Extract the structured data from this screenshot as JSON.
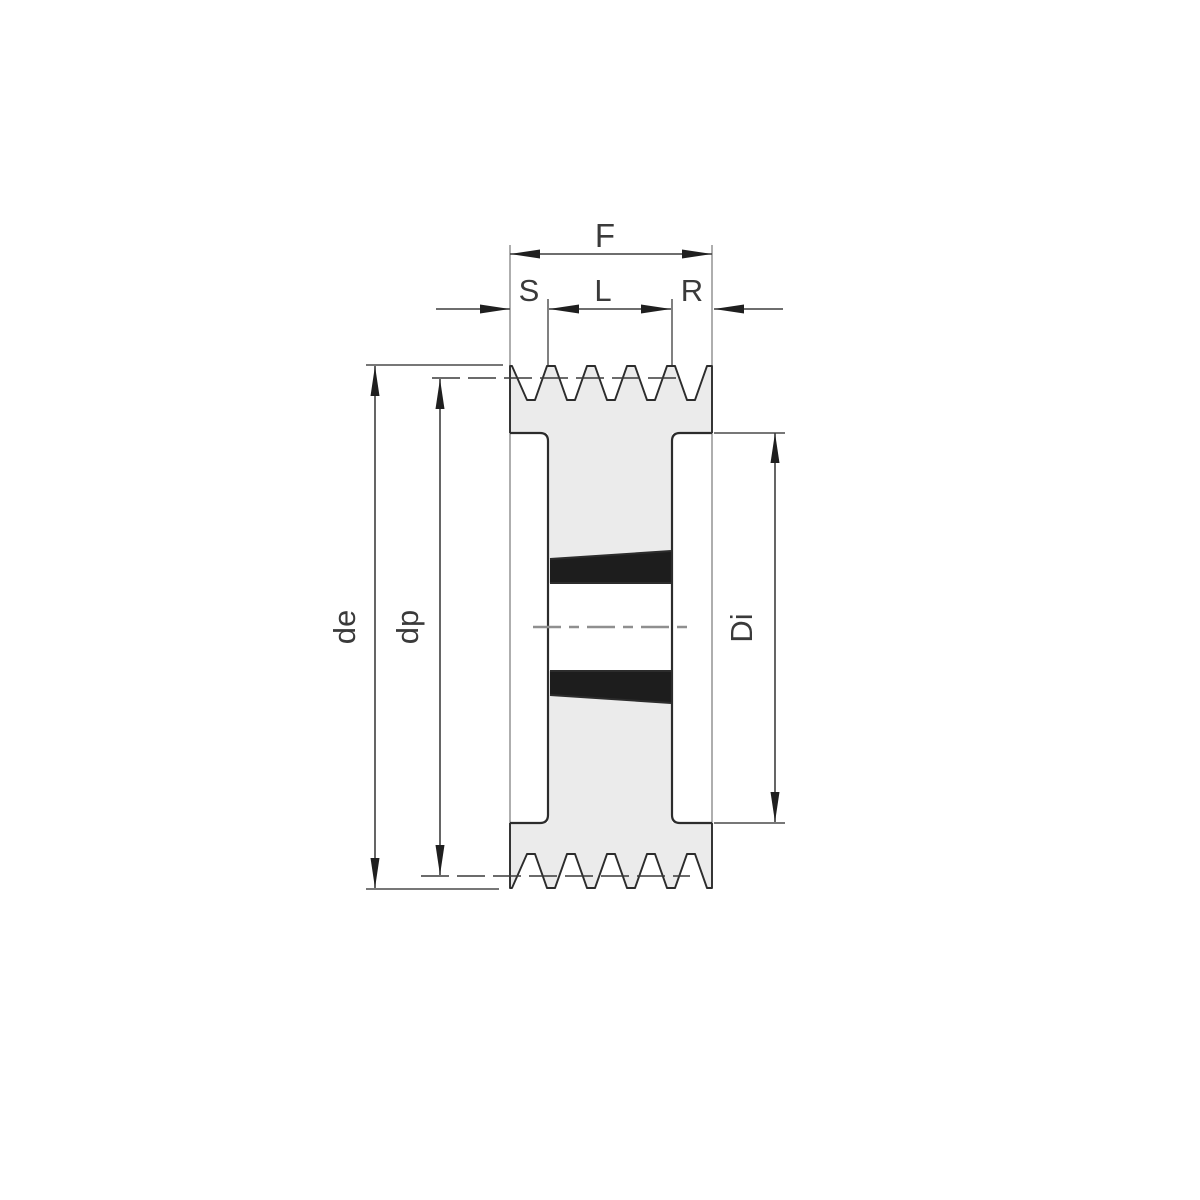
{
  "drawing": {
    "type": "technical-section-view",
    "subject": "V-belt pulley with taper bushing, cross-section with dimension lines",
    "groove_count": 5,
    "labels": {
      "total_width": "F",
      "offset_left": "S",
      "bushing_length": "L",
      "offset_right": "R",
      "outer_diameter": "de",
      "pitch_diameter": "dp",
      "inner_rim_diameter": "Di"
    },
    "colors": {
      "background": "#ffffff",
      "body_fill": "#ebebeb",
      "bore_fill": "#ffffff",
      "bushing_fill": "#1d1d1d",
      "outline": "#2c2c2c",
      "dimension": "#3f3f3f",
      "centerline": "#8f8f8f",
      "text": "#3a3a3a"
    }
  }
}
